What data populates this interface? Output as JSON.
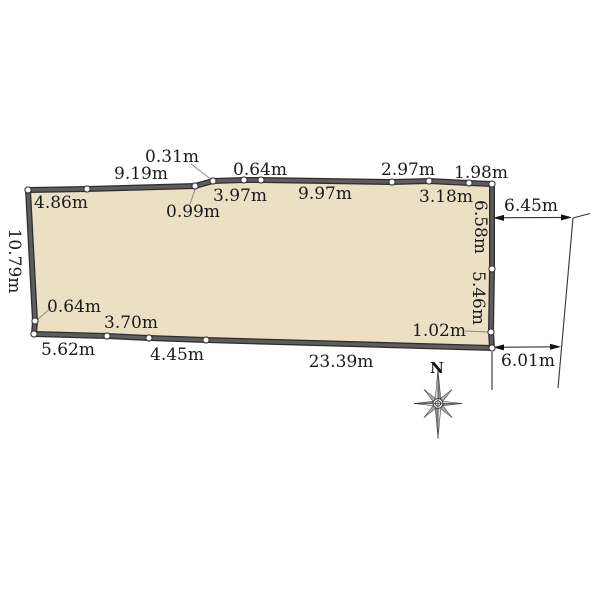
{
  "colors": {
    "background": "#ffffff",
    "parcel_fill": "#ece0c4",
    "boundary_stroke": "#4a4a4a",
    "line_color": "#333333",
    "text_color": "#1a1a1a"
  },
  "parcel": {
    "top_outside_labels": [
      "0.31m",
      "9.19m",
      "0.64m",
      "2.97m",
      "1.98m"
    ],
    "top_inside_labels": [
      "4.86m",
      "0.99m",
      "3.97m",
      "9.97m",
      "3.18m"
    ],
    "left_outside_label": "10.79m",
    "right_inside_labels": [
      "6.58m",
      "5.46m"
    ],
    "bottom_inside_labels": [
      "0.64m",
      "3.70m",
      "1.02m"
    ],
    "bottom_outside_labels": [
      "5.62m",
      "4.45m",
      "23.39m"
    ]
  },
  "road": {
    "upper_width_label": "6.45m",
    "lower_width_label": "6.01m"
  },
  "compass": {
    "north_label": "N"
  }
}
